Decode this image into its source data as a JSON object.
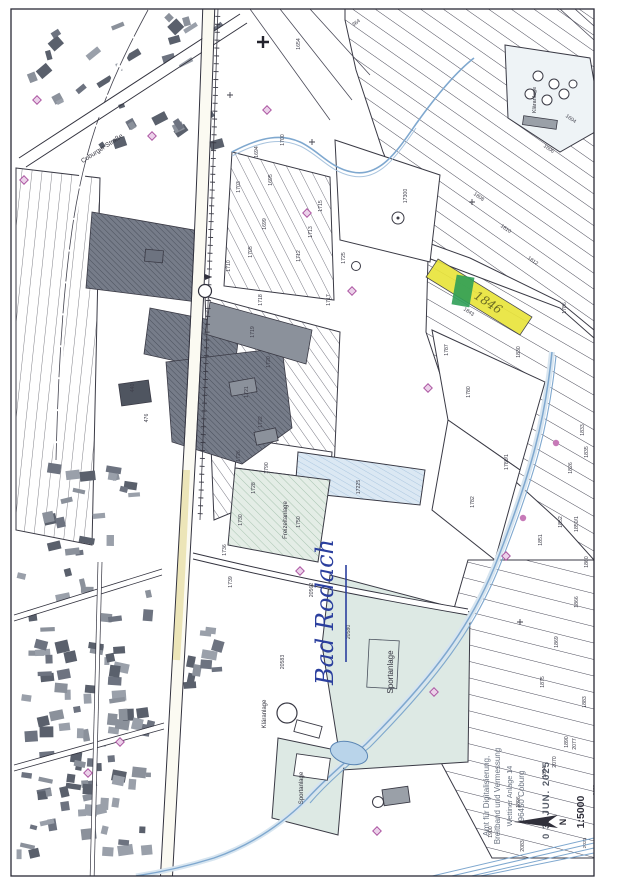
{
  "map": {
    "scale_text": "1:5000",
    "north_label": "N",
    "small_numbers_near_scale": [
      "2072",
      "2023"
    ],
    "handwriting": {
      "place_note": {
        "text": "Bad Rodach",
        "color": "#2b3f9e"
      },
      "parcel_note": {
        "text": "1846",
        "color": "#6b6b24"
      }
    },
    "stamp": {
      "lines": [
        "Amt für Digitalisierung,",
        "Breitband und Vermessung",
        "Wettiner Anlage 14",
        "96450 Coburg"
      ],
      "date": "0 3. JUN. 2025",
      "ink": "#566070"
    },
    "highlight": {
      "fill": "#e9e43c",
      "marker": "#2f9e57"
    },
    "labels": [
      {
        "text": "Coburger Straße",
        "x": 103,
        "y": 150,
        "r": -33,
        "s": 6.5
      },
      {
        "text": "Sportanlage",
        "x": 393,
        "y": 672,
        "r": -90,
        "s": 8
      },
      {
        "text": "Sportanlage",
        "x": 303,
        "y": 788,
        "r": -90,
        "s": 6
      },
      {
        "text": "Kläranlage",
        "x": 266,
        "y": 714,
        "r": -90,
        "s": 6
      },
      {
        "text": "Kläranlage",
        "x": 536,
        "y": 100,
        "r": -90,
        "s": 5.5
      },
      {
        "text": "Freizeitanlage",
        "x": 287,
        "y": 520,
        "r": -90,
        "s": 6
      }
    ],
    "parcel_numbers": [
      {
        "t": "364",
        "x": 357,
        "y": 24,
        "r": -35
      },
      {
        "t": "1654",
        "x": 300,
        "y": 44
      },
      {
        "t": "1700",
        "x": 284,
        "y": 140
      },
      {
        "t": "1694",
        "x": 258,
        "y": 152
      },
      {
        "t": "1695",
        "x": 272,
        "y": 180
      },
      {
        "t": "1703",
        "x": 240,
        "y": 187
      },
      {
        "t": "1699",
        "x": 266,
        "y": 224
      },
      {
        "t": "1705",
        "x": 252,
        "y": 252
      },
      {
        "t": "1710",
        "x": 230,
        "y": 266
      },
      {
        "t": "1712",
        "x": 300,
        "y": 256
      },
      {
        "t": "1713",
        "x": 312,
        "y": 232
      },
      {
        "t": "1715",
        "x": 322,
        "y": 206
      },
      {
        "t": "1725",
        "x": 345,
        "y": 258
      },
      {
        "t": "17300",
        "x": 407,
        "y": 196
      },
      {
        "t": "1717",
        "x": 330,
        "y": 300
      },
      {
        "t": "1718",
        "x": 262,
        "y": 300
      },
      {
        "t": "1719",
        "x": 254,
        "y": 332
      },
      {
        "t": "1720",
        "x": 270,
        "y": 362
      },
      {
        "t": "1721",
        "x": 248,
        "y": 392
      },
      {
        "t": "1722",
        "x": 262,
        "y": 422
      },
      {
        "t": "1726",
        "x": 240,
        "y": 456
      },
      {
        "t": "1728",
        "x": 255,
        "y": 488
      },
      {
        "t": "1730",
        "x": 242,
        "y": 520
      },
      {
        "t": "1736",
        "x": 226,
        "y": 550
      },
      {
        "t": "1739",
        "x": 232,
        "y": 582
      },
      {
        "t": "1750",
        "x": 300,
        "y": 522
      },
      {
        "t": "1790",
        "x": 268,
        "y": 468
      },
      {
        "t": "17225",
        "x": 360,
        "y": 487
      },
      {
        "t": "1604",
        "x": 570,
        "y": 120,
        "r": 35
      },
      {
        "t": "1606",
        "x": 548,
        "y": 150,
        "r": 35
      },
      {
        "t": "1808",
        "x": 478,
        "y": 198,
        "r": 35
      },
      {
        "t": "1810",
        "x": 505,
        "y": 230,
        "r": 35
      },
      {
        "t": "1812",
        "x": 532,
        "y": 262,
        "r": 35
      },
      {
        "t": "1843",
        "x": 468,
        "y": 313,
        "r": 33
      },
      {
        "t": "1830",
        "x": 520,
        "y": 352
      },
      {
        "t": "1786",
        "x": 566,
        "y": 308
      },
      {
        "t": "1787",
        "x": 448,
        "y": 350
      },
      {
        "t": "1780",
        "x": 470,
        "y": 392
      },
      {
        "t": "1780/1",
        "x": 508,
        "y": 462
      },
      {
        "t": "1782",
        "x": 474,
        "y": 502
      },
      {
        "t": "1833",
        "x": 584,
        "y": 430
      },
      {
        "t": "1835",
        "x": 588,
        "y": 452
      },
      {
        "t": "1826",
        "x": 572,
        "y": 468
      },
      {
        "t": "1852",
        "x": 562,
        "y": 522
      },
      {
        "t": "1850/1",
        "x": 578,
        "y": 524
      },
      {
        "t": "1851",
        "x": 542,
        "y": 540
      },
      {
        "t": "1860",
        "x": 588,
        "y": 562
      },
      {
        "t": "1866",
        "x": 578,
        "y": 602
      },
      {
        "t": "1869",
        "x": 558,
        "y": 642
      },
      {
        "t": "1875",
        "x": 544,
        "y": 682
      },
      {
        "t": "1883",
        "x": 586,
        "y": 702
      },
      {
        "t": "1890",
        "x": 568,
        "y": 742
      },
      {
        "t": "1894",
        "x": 546,
        "y": 772
      },
      {
        "t": "1896",
        "x": 520,
        "y": 802
      },
      {
        "t": "1900",
        "x": 492,
        "y": 832
      },
      {
        "t": "2083",
        "x": 524,
        "y": 846
      },
      {
        "t": "2070",
        "x": 556,
        "y": 762
      },
      {
        "t": "2077",
        "x": 576,
        "y": 744
      },
      {
        "t": "440",
        "x": 134,
        "y": 388
      },
      {
        "t": "476",
        "x": 148,
        "y": 418
      },
      {
        "t": "20562",
        "x": 313,
        "y": 590
      },
      {
        "t": "20583",
        "x": 284,
        "y": 662
      },
      {
        "t": "20580",
        "x": 350,
        "y": 632
      }
    ]
  }
}
